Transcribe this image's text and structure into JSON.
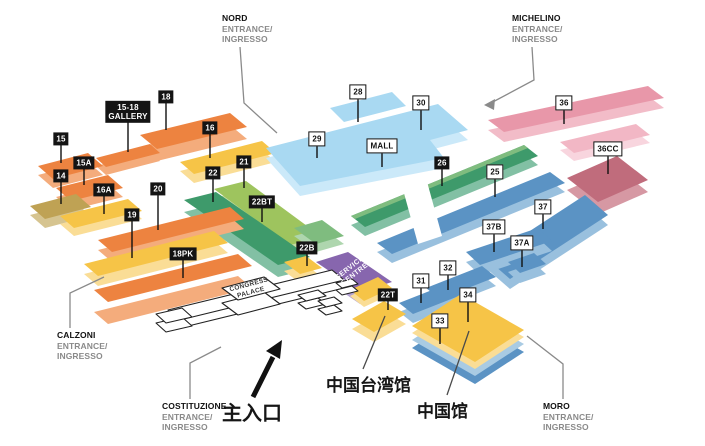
{
  "halls": {
    "h15": "15",
    "h15a": "15A",
    "h14": "14",
    "h16a": "16A",
    "h16": "16",
    "h18": "18",
    "gallery": [
      "15-18",
      "GALLERY"
    ],
    "h20": "20",
    "h19": "19",
    "h18pk": "18PK",
    "h22": "22",
    "h21": "21",
    "h22bt": "22BT",
    "h22b": "22B",
    "h22t": "22T",
    "h26": "26",
    "h28": "28",
    "h29": "29",
    "h30": "30",
    "mall": "MALL",
    "h36": "36",
    "h36cc": "36CC",
    "h25": "25",
    "h37": "37",
    "h37b": "37B",
    "h37a": "37A",
    "h31": "31",
    "h32": "32",
    "h33": "33",
    "h34": "34"
  },
  "service_centre": [
    "SERVICE",
    "CENTRE"
  ],
  "congress_palace": [
    "CONGRESS",
    "PALACE"
  ],
  "entrances": {
    "nord": {
      "name": "NORD",
      "sub": [
        "ENTRANCE/",
        "INGRESSO"
      ]
    },
    "michelino": {
      "name": "MICHELINO",
      "sub": [
        "ENTRANCE/",
        "INGRESSO"
      ]
    },
    "calzoni": {
      "name": "CALZONI",
      "sub": [
        "ENTRANCE/",
        "INGRESSO"
      ]
    },
    "costituzione": {
      "name": "COSTITUZIONE",
      "sub": [
        "ENTRANCE/",
        "INGRESSO"
      ]
    },
    "moro": {
      "name": "MORO",
      "sub": [
        "ENTRANCE/",
        "INGRESSO"
      ]
    }
  },
  "annotations": {
    "main_entrance": "主入口",
    "taiwan_pavilion": "中国台湾馆",
    "china_pavilion": "中国馆"
  },
  "colors": {
    "orange": "#ED8340",
    "orange_side": "#F4AC7C",
    "yellow": "#F6C447",
    "yellow_side": "#FADD96",
    "tan": "#BFA254",
    "tan_side": "#D6C490",
    "green_dark": "#3E9A6B",
    "green_dark_side": "#82C0A4",
    "green_light": "#9EC45E",
    "green_light_side": "#C6DCA4",
    "green_mid": "#7FBC7F",
    "green_mid_side": "#AED6AE",
    "blue_light": "#A9D9F2",
    "blue_light_side": "#CBE9F9",
    "blue": "#5B93C4",
    "blue_side": "#99C0DE",
    "pink": "#E897A9",
    "pink_side": "#F2BCC8",
    "pink_pale": "#F2B7C5",
    "pink_pale_side": "#F8D5DE",
    "mauve": "#C06C7C",
    "mauve_side": "#D698A3",
    "purple": "#8766AE",
    "purple_side": "#B4A3D2",
    "platform_top": "#A9CBE3",
    "white": "#FFFFFF",
    "ink": "#111111",
    "leader": "#8A8A8A"
  }
}
